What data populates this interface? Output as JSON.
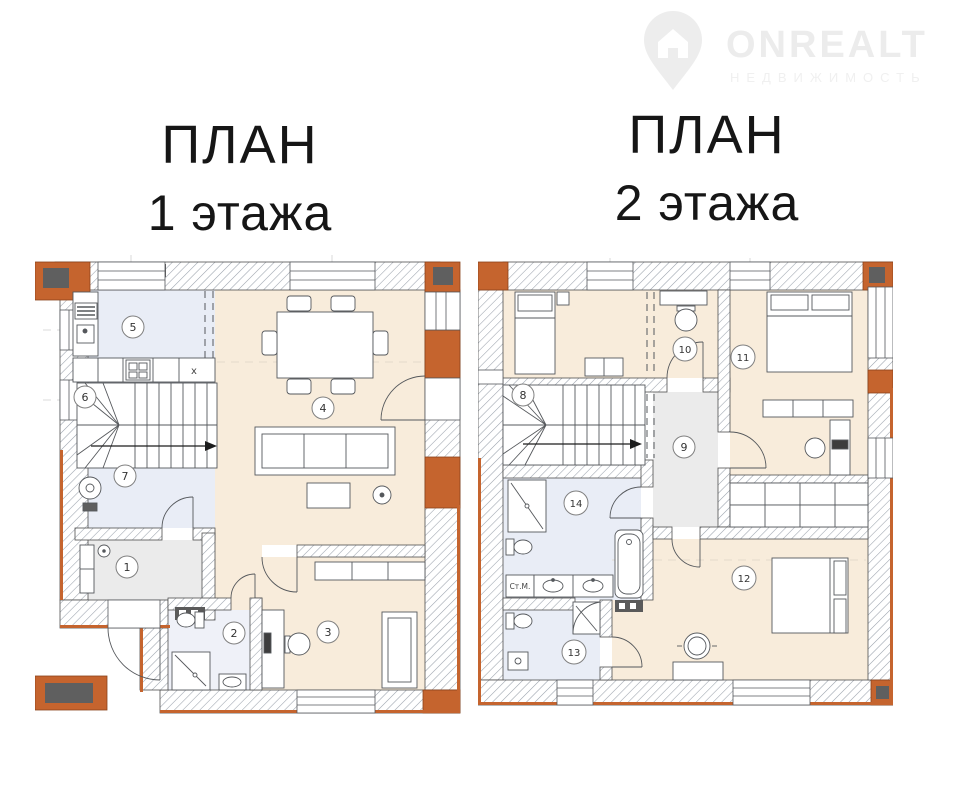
{
  "watermark": {
    "brand": "ONREALT",
    "subtitle": "НЕДВИЖИМОСТЬ"
  },
  "floor1": {
    "title_line1": "ПЛАН",
    "title_line2": "1 этажа"
  },
  "floor2": {
    "title_line1": "ПЛАН",
    "title_line2": "2 этажа"
  },
  "rooms": {
    "r1": "1",
    "r2": "2",
    "r3": "3",
    "r4": "4",
    "r5": "5",
    "r6": "6",
    "r7": "7",
    "r8": "8",
    "r9": "9",
    "r10": "10",
    "r11": "11",
    "r12": "12",
    "r13": "13",
    "r14": "14"
  },
  "labels": {
    "kitchen_unit": "x",
    "washing_machine": "Ст.М."
  },
  "colors": {
    "accent_brick": "#c5642e",
    "room_beige": "#f8ecdb",
    "room_lavender": "#e9edf6",
    "room_gray": "#ebebeb",
    "room_pale": "#eff1f8",
    "wall_hatch": "#9aa2ac"
  }
}
